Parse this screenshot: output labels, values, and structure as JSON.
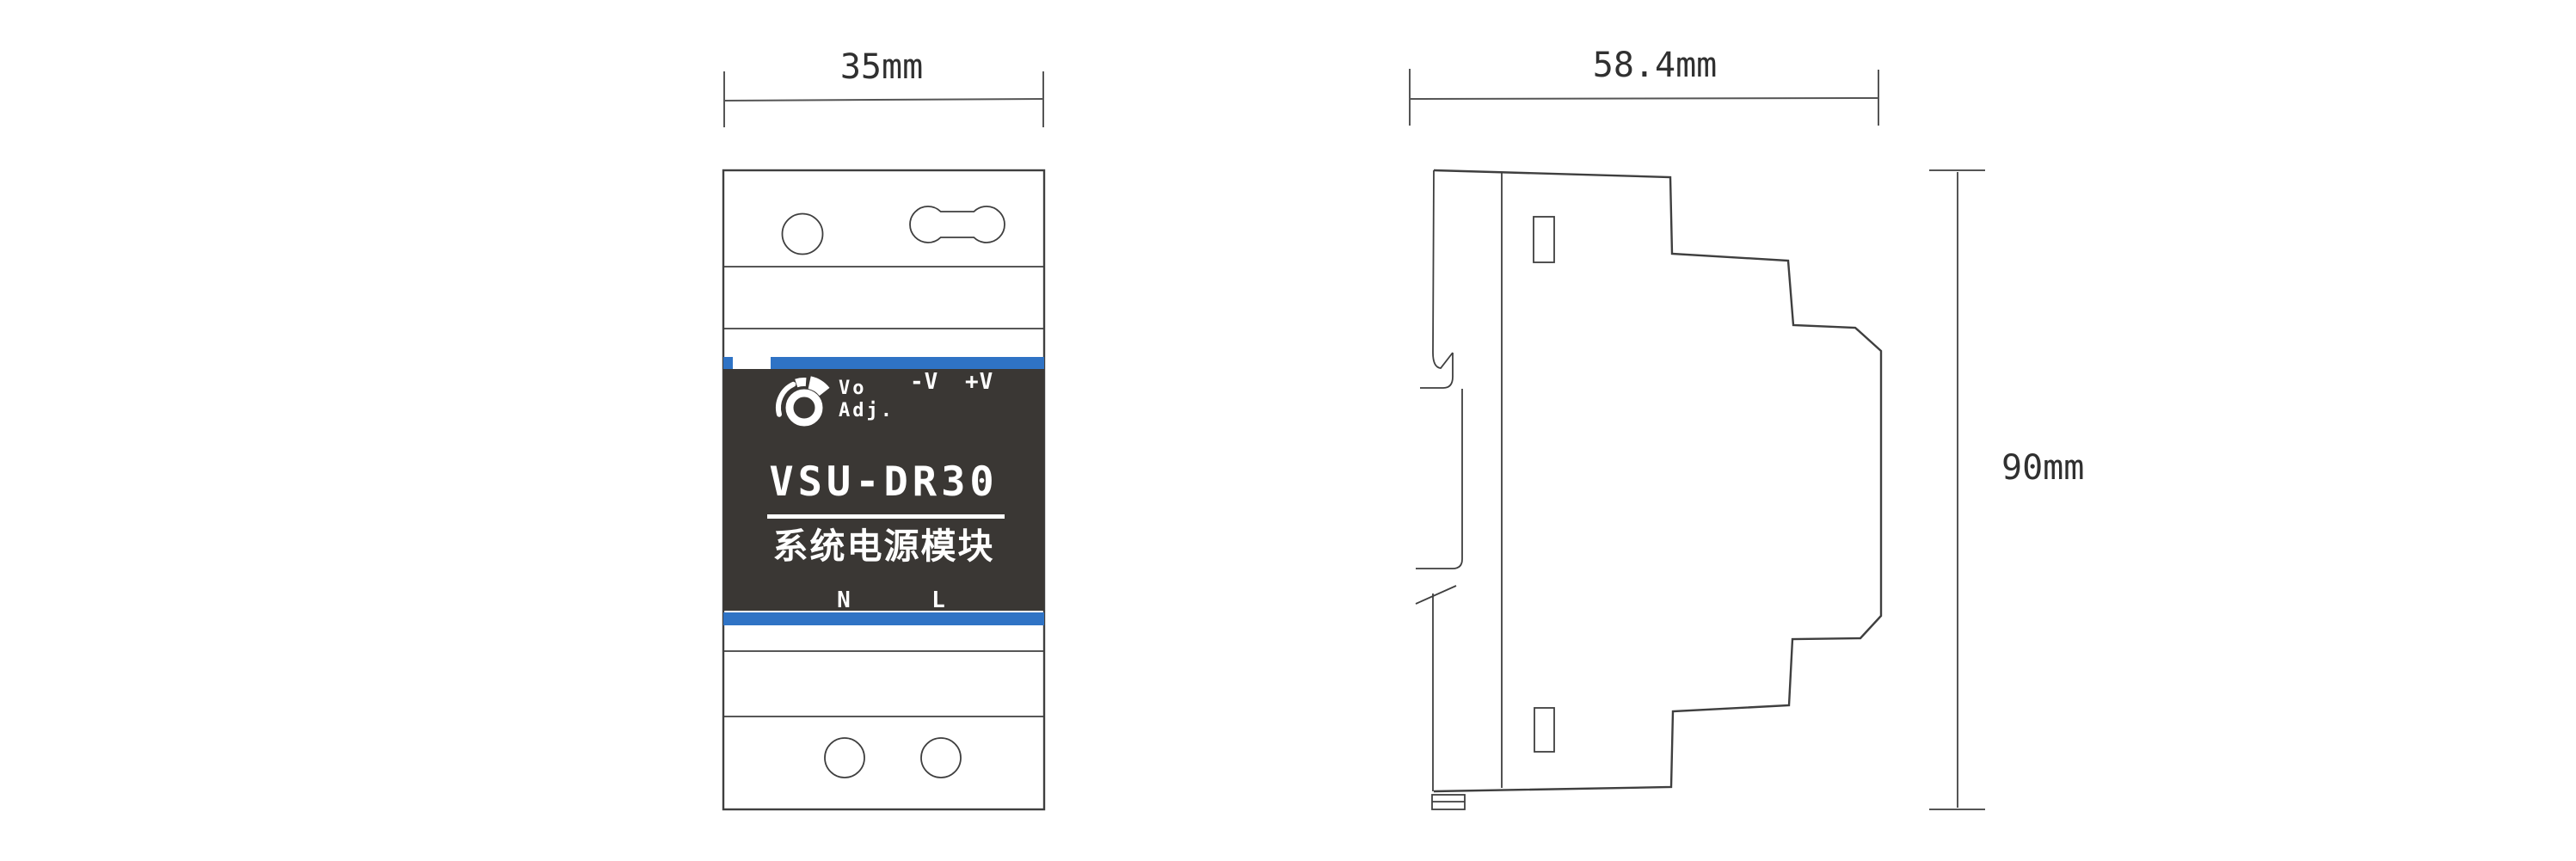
{
  "drawing": {
    "type": "product dimension drawing",
    "product_model": "VSU-DR30"
  },
  "front_view": {
    "width_label": "35mm",
    "knob": {
      "line1": "Vo",
      "line2": "Adj."
    },
    "output_terminals": {
      "negative": "-V",
      "positive": "+V"
    },
    "model": "VSU-DR30",
    "product_name": "系统电源模块",
    "input_terminals": {
      "neutral": "N",
      "live": "L"
    }
  },
  "side_view": {
    "depth_label": "58.4mm",
    "height_label": "90mm"
  },
  "colors": {
    "accent_blue": "#2F73C5",
    "panel_dark": "#3A3734",
    "outline": "#3F3F3F",
    "dimension_line": "#555555"
  }
}
